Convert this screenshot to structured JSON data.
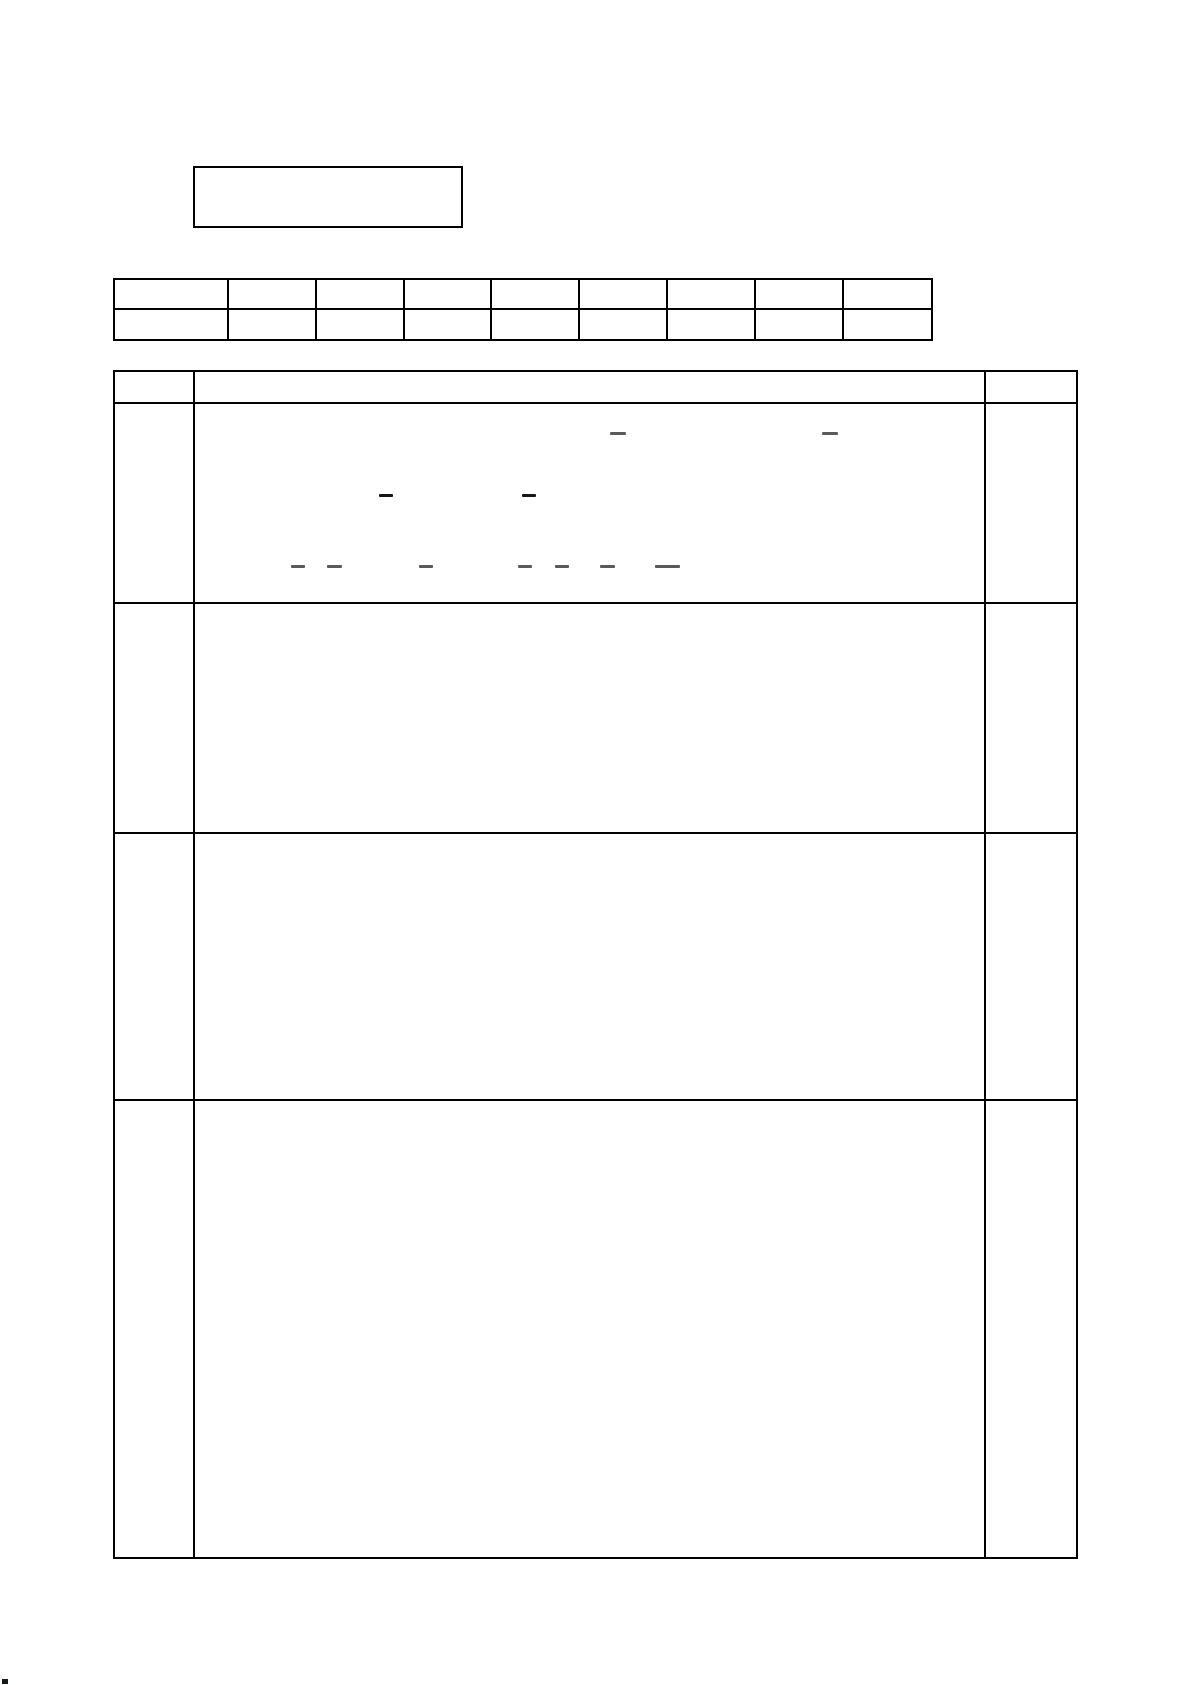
{
  "page": {
    "background": "#ffffff",
    "width": 1192,
    "height": 1685,
    "border_color": "#000000"
  },
  "top_box": {
    "text": "",
    "x": 193,
    "y": 166,
    "width": 270,
    "height": 62
  },
  "header_grid": {
    "x": 113,
    "y": 278,
    "column_widths": [
      114,
      88,
      88,
      87,
      88,
      88,
      88,
      88,
      89
    ],
    "row_heights": [
      30,
      31
    ],
    "rows": [
      [
        "",
        "",
        "",
        "",
        "",
        "",
        "",
        "",
        ""
      ],
      [
        "",
        "",
        "",
        "",
        "",
        "",
        "",
        "",
        ""
      ]
    ]
  },
  "main_table": {
    "x": 113,
    "y": 370,
    "column_widths": [
      80,
      791,
      92
    ],
    "row_heights": [
      32,
      200,
      230,
      267,
      458
    ],
    "header": [
      "",
      "",
      ""
    ],
    "rows": [
      [
        "",
        "",
        ""
      ],
      [
        "",
        "",
        ""
      ],
      [
        "",
        "",
        ""
      ],
      [
        "",
        "",
        ""
      ]
    ]
  },
  "handwritten_marks": {
    "shade_gray": "#5a5a5a",
    "shade_dark": "#161616",
    "dashes": [
      {
        "x": 610,
        "y": 432,
        "w": 16,
        "shade": "shade_gray"
      },
      {
        "x": 822,
        "y": 432,
        "w": 16,
        "shade": "shade_gray"
      },
      {
        "x": 379,
        "y": 494,
        "w": 14,
        "shade": "shade_dark"
      },
      {
        "x": 522,
        "y": 494,
        "w": 14,
        "shade": "shade_dark"
      },
      {
        "x": 291,
        "y": 565,
        "w": 14,
        "shade": "shade_gray"
      },
      {
        "x": 327,
        "y": 565,
        "w": 15,
        "shade": "shade_gray"
      },
      {
        "x": 419,
        "y": 565,
        "w": 14,
        "shade": "shade_gray"
      },
      {
        "x": 518,
        "y": 565,
        "w": 14,
        "shade": "shade_gray"
      },
      {
        "x": 555,
        "y": 565,
        "w": 14,
        "shade": "shade_gray"
      },
      {
        "x": 600,
        "y": 565,
        "w": 15,
        "shade": "shade_gray"
      },
      {
        "x": 655,
        "y": 565,
        "w": 25,
        "shade": "shade_gray"
      }
    ]
  },
  "artifacts": {
    "corner_dot": {
      "x": 2,
      "y": 1679,
      "w": 6,
      "h": 5,
      "color": "#101820"
    }
  }
}
